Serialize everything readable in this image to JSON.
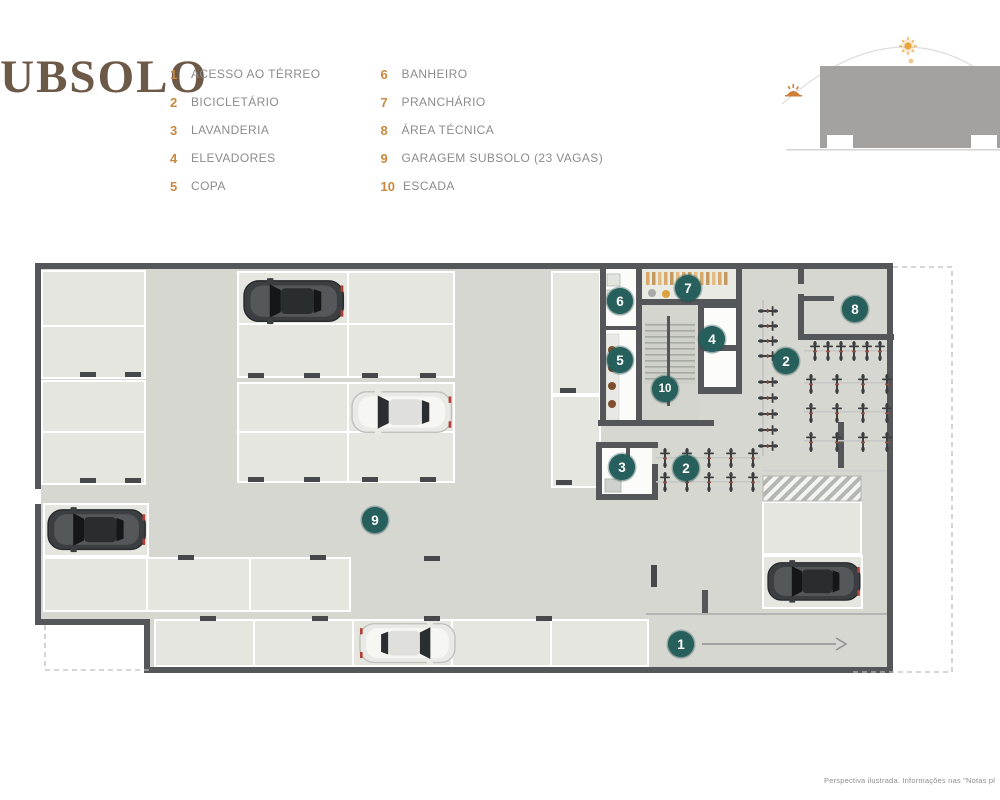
{
  "title": "SUBSOLO",
  "footer_note": "Perspectiva ilustrada. Informações nas \"Notas pl",
  "legend": {
    "col1": [
      {
        "num": "1",
        "label": "ACESSO AO TÉRREO"
      },
      {
        "num": "2",
        "label": "BICICLETÁRIO"
      },
      {
        "num": "3",
        "label": "LAVANDERIA"
      },
      {
        "num": "4",
        "label": "ELEVADORES"
      },
      {
        "num": "5",
        "label": "COPA"
      }
    ],
    "col2": [
      {
        "num": "6",
        "label": "BANHEIRO"
      },
      {
        "num": "7",
        "label": "PRANCHÁRIO"
      },
      {
        "num": "8",
        "label": "ÁREA TÉCNICA"
      },
      {
        "num": "9",
        "label": "GARAGEM SUBSOLO (23 VAGAS)"
      },
      {
        "num": "10",
        "label": "ESCADA"
      }
    ]
  },
  "plan": {
    "markers": [
      {
        "num": "1",
        "name": "acesso-ao-terreo",
        "x": 681,
        "y": 644
      },
      {
        "num": "2",
        "name": "bicicletario-direita",
        "x": 786,
        "y": 361
      },
      {
        "num": "2",
        "name": "bicicletario-centro",
        "x": 686,
        "y": 468
      },
      {
        "num": "3",
        "name": "lavanderia",
        "x": 622,
        "y": 467
      },
      {
        "num": "4",
        "name": "elevadores",
        "x": 712,
        "y": 339
      },
      {
        "num": "5",
        "name": "copa",
        "x": 620,
        "y": 360
      },
      {
        "num": "6",
        "name": "banheiro",
        "x": 620,
        "y": 301
      },
      {
        "num": "7",
        "name": "pranchario",
        "x": 688,
        "y": 288
      },
      {
        "num": "8",
        "name": "area-tecnica",
        "x": 855,
        "y": 309
      },
      {
        "num": "9",
        "name": "garagem-subsolo",
        "x": 375,
        "y": 520
      },
      {
        "num": "10",
        "name": "escada",
        "x": 665,
        "y": 389
      }
    ]
  },
  "icons": {
    "sun-icon": "orange sun with rays on sun-path arc",
    "sunset-icon": "small orange sunrise glyph at arc end",
    "bicycle-icon": "top-view bicycle glyph (bike racks)",
    "car-icon": "top-view car illustration",
    "direction-arrow-icon": "right arrow (ramp to ground floor)",
    "wheel-stop-icon": "dark dash at parking space end",
    "hatch-area-icon": "diagonal-striped no-parking zone"
  },
  "colors": {
    "title": "#6d5948",
    "legend_number": "#c8883f",
    "legend_label": "#8c8c8c",
    "marker_bg": "#265f5b",
    "marker_text": "#ffffff",
    "wall": "#54565a",
    "floor": "#d5d7d0",
    "space": "#e4e6df",
    "space_border": "#ffffff",
    "wheel_stop": "#46484b",
    "accent_sun": "#e8a43d",
    "dashed_line": "#bdbdbd"
  }
}
